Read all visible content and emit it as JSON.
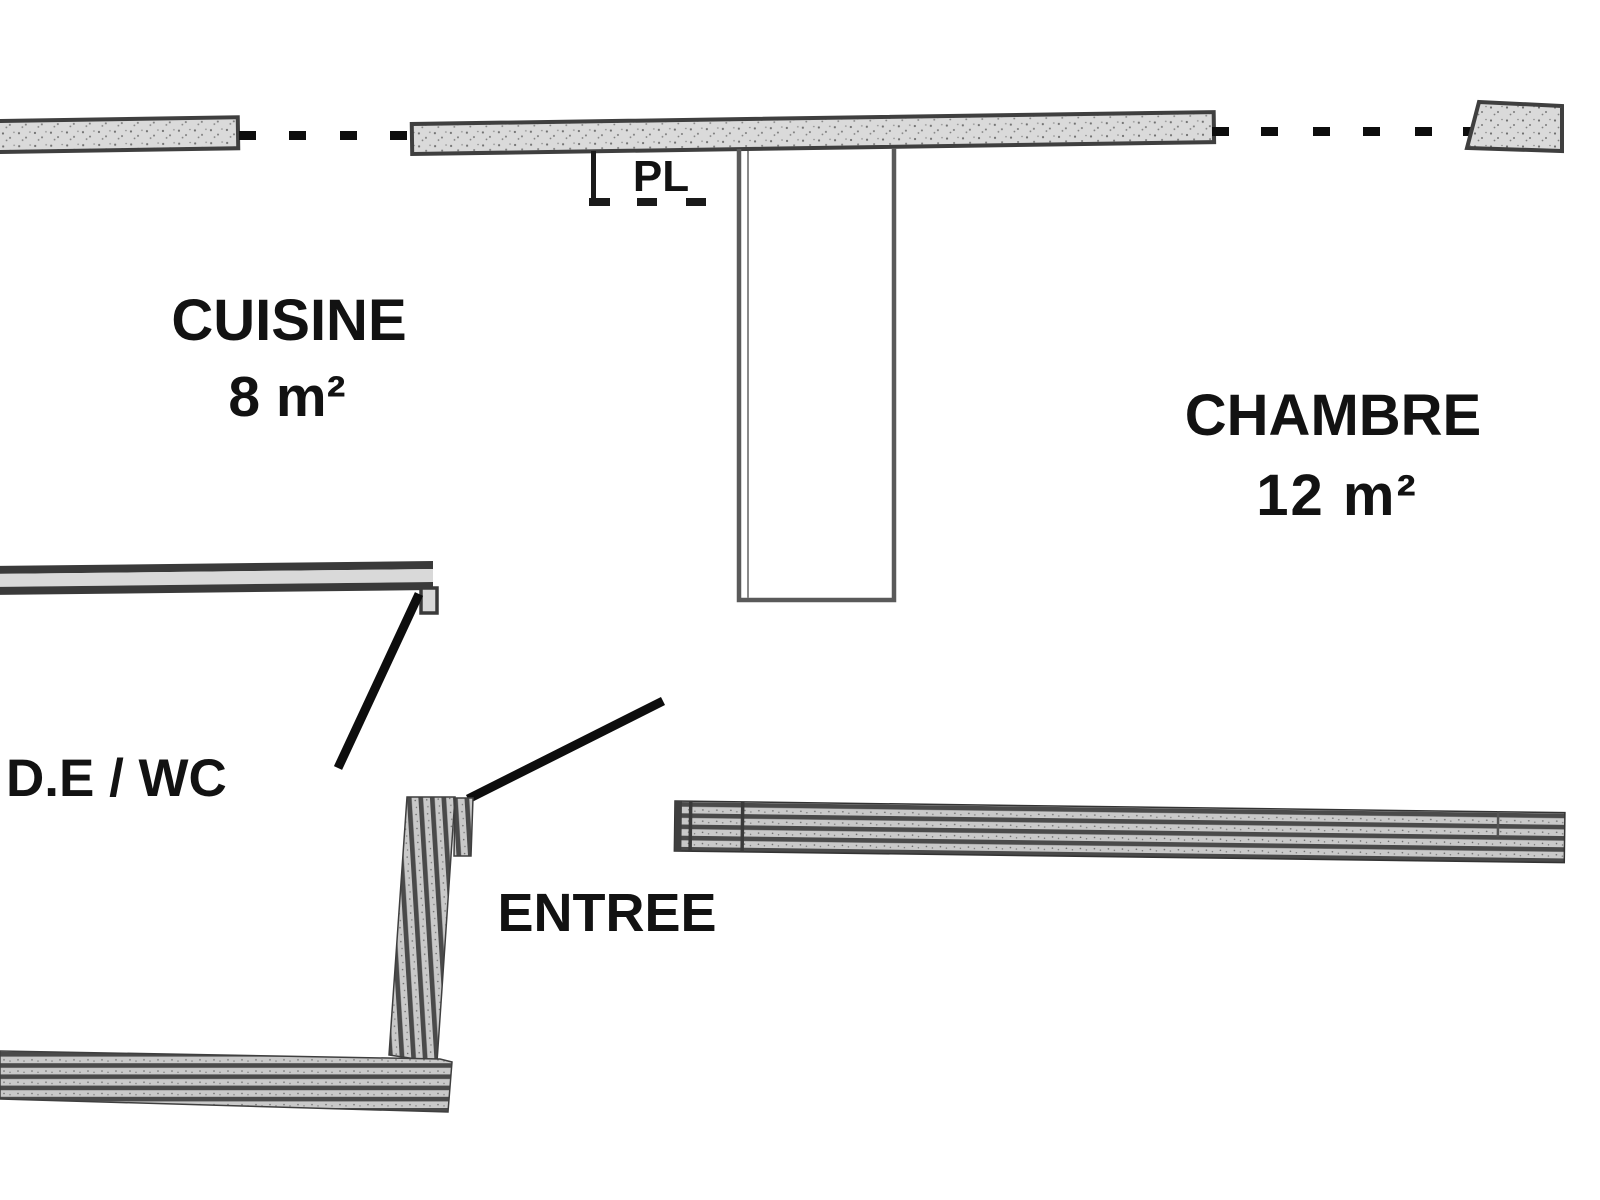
{
  "plan": {
    "rooms": [
      {
        "id": "cuisine",
        "label": "CUISINE",
        "area": "8 m²"
      },
      {
        "id": "chambre",
        "label": "CHAMBRE",
        "area": "12 m²"
      },
      {
        "id": "de-wc",
        "label": "D.E / WC"
      },
      {
        "id": "entree",
        "label": "ENTREE"
      }
    ],
    "closet_label": "PL",
    "colors": {
      "background": "#ffffff",
      "wall_fill": "#dadada",
      "wall_outline": "#3f3f3f",
      "stripe_dark": "#4a4a4a",
      "stripe_light": "#c9c9c9",
      "door_line": "#0d0d0d",
      "text": "#121212"
    }
  }
}
